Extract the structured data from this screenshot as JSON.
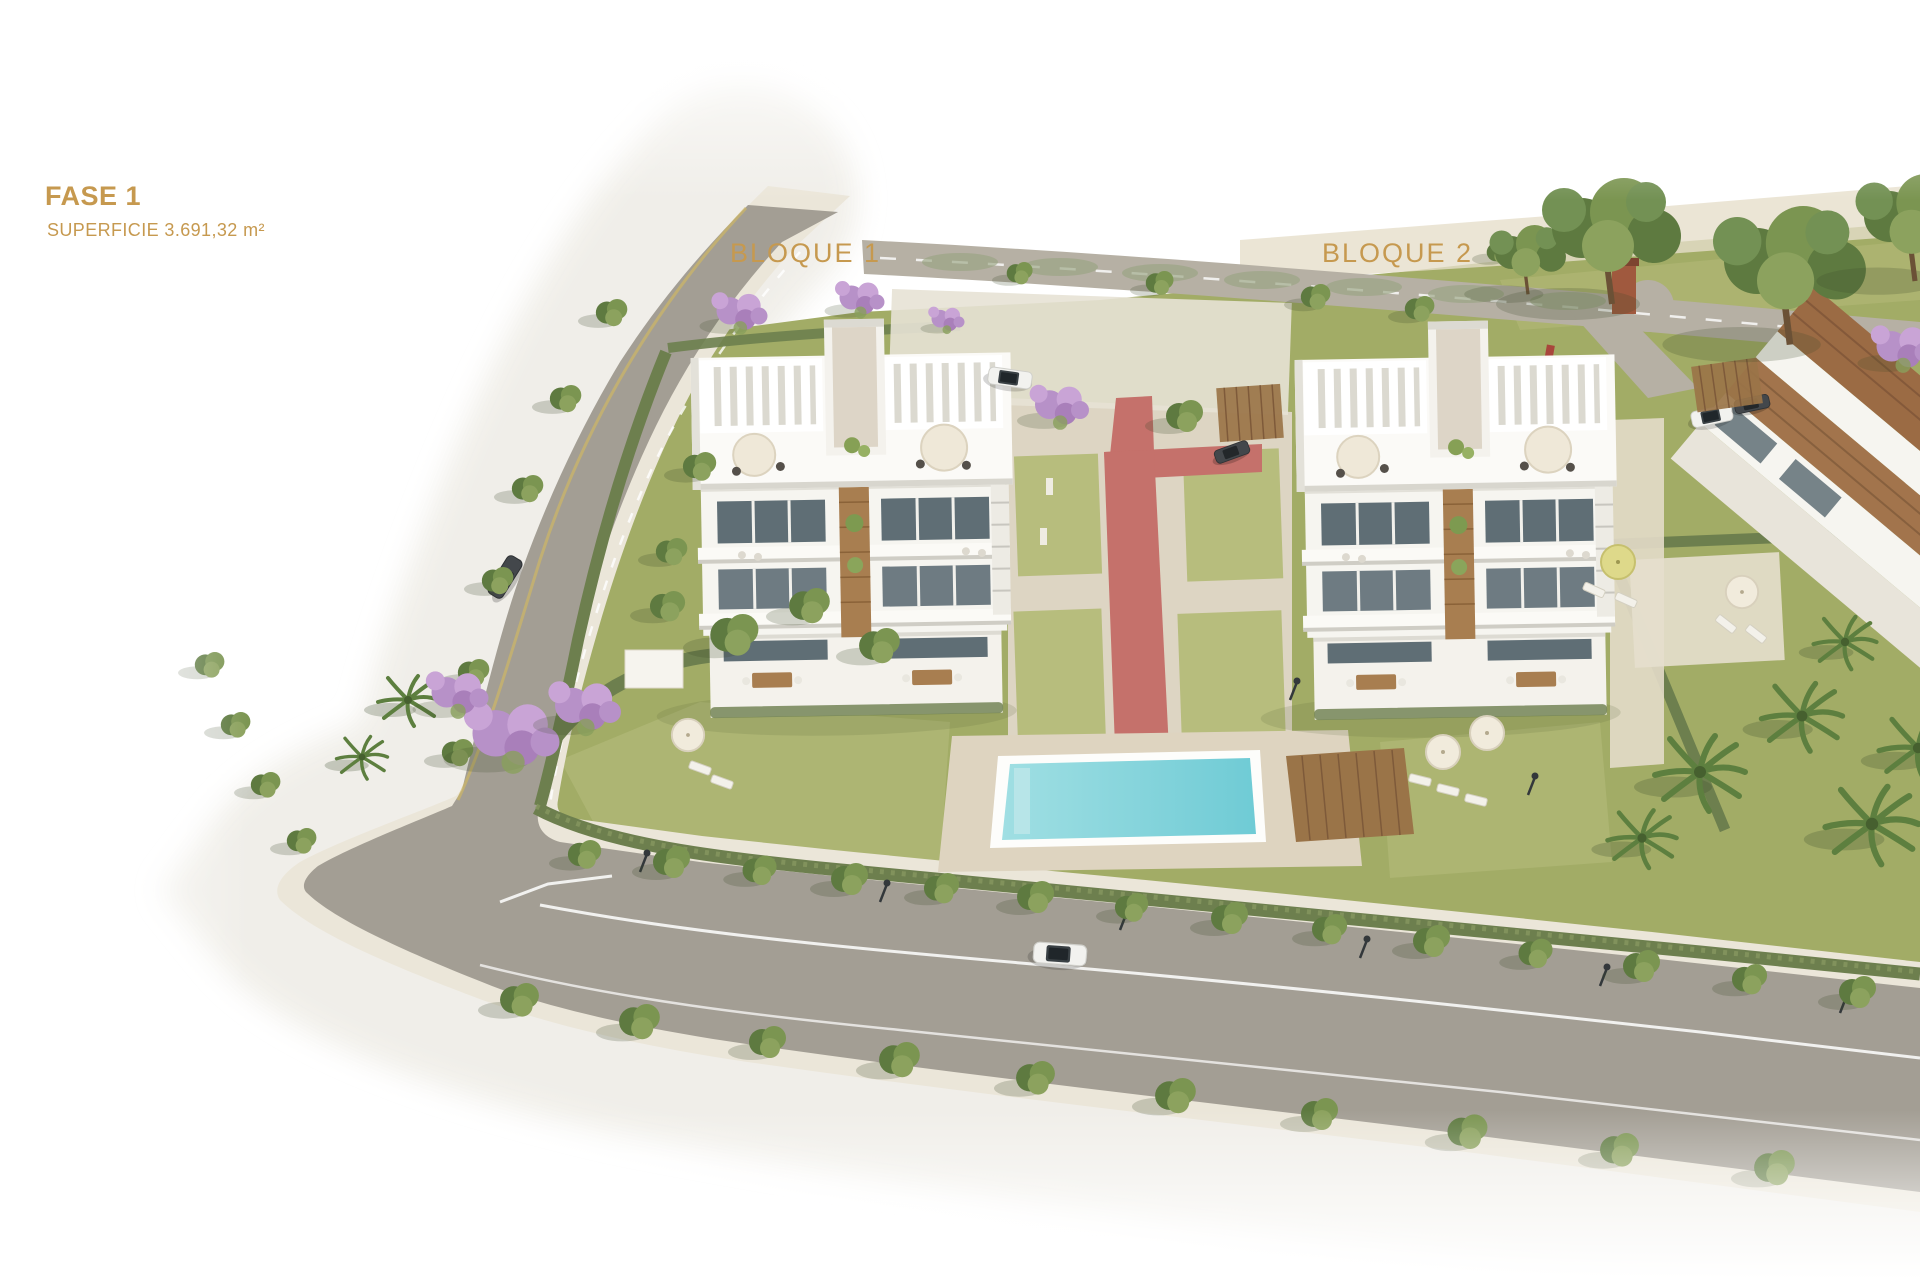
{
  "annotations": {
    "phase": {
      "label": "FASE 1"
    },
    "area": {
      "label": "SUPERFICIE 3.691,32 m²"
    },
    "block1": {
      "label": "BLOQUE 1"
    },
    "block2": {
      "label": "BLOQUE 2"
    }
  },
  "scene": {
    "description": "Aerial 3D render of phase 1 of a residential development: two white apartment blocks with rooftop pergolas, a communal pool with wooden deck, red pedestrian path, olive lawns with hedges, jacaranda and palm trees, a partial third building at right, and a tree-lined perimeter road with parked cars fading to a white background."
  },
  "palette": {
    "label_gold": "#c6994f",
    "road_asphalt": "#a39e94",
    "road_upper": "#b6b0a4",
    "sidewalk": "#ebe6d9",
    "terrain": "#f0eee8",
    "grass": "#a2ac66",
    "grass_light": "#b7bd7d",
    "hedge": "#6d7f4e",
    "tree_green": "#7b9551",
    "tree_dark": "#5e7a40",
    "jacaranda": "#b791c8",
    "pool_water": "#a0dfe3",
    "pool_water_deep": "#6fcbd5",
    "pool_deck": "#ded4c0",
    "wood": "#a87e50",
    "wood_deck": "#9a7448",
    "glass": "#5f6e75",
    "building_white": "#f6f5f0",
    "brick": "#a0593e",
    "path_red": "#c5716b"
  }
}
